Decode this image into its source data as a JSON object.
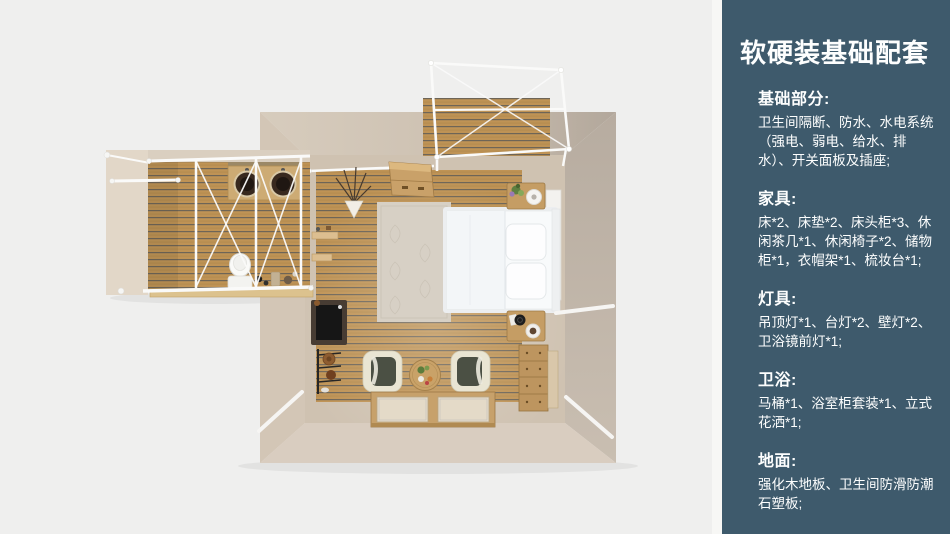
{
  "colors": {
    "canvas_bg": "#efefee",
    "panel_bg": "#3e5a6c",
    "panel_text": "#fdfefe",
    "wood": "#bf9355",
    "wood_gap": "#6e6557",
    "wall": "#cfc2b1",
    "wall_light": "#d8ccbe",
    "wall_dark": "#b3a89c",
    "frame_white": "#fafaf9",
    "bed_white": "#f8fafb"
  },
  "sidebar": {
    "title": "软硬装基础配套",
    "sections": [
      {
        "heading": "基础部分:",
        "body": "卫生间隔断、防水、水电系统（强电、弱电、给水、排水）、开关面板及插座;"
      },
      {
        "heading": "家具:",
        "body": "床*2、床垫*2、床头柜*3、休闲茶几*1、休闲椅子*2、储物柜*1，衣帽架*1、梳妆台*1;"
      },
      {
        "heading": "灯具:",
        "body": "吊顶灯*1、台灯*2、壁灯*2、卫浴镜前灯*1;"
      },
      {
        "heading": "卫浴:",
        "body": "马桶*1、浴室柜套装*1、立式花洒*1;"
      },
      {
        "heading": "地面:",
        "body": "强化木地板、卫生间防滑防潮石塑板;"
      }
    ]
  },
  "floorplan": {
    "view": "top-down-3d-render",
    "rooms": [
      "bedroom",
      "bathroom-wing",
      "balcony-deck"
    ],
    "elements": [
      "double-bed",
      "area-rug",
      "storage-cabinet",
      "nightstand",
      "nightstand",
      "lounge-chair",
      "lounge-chair",
      "coffee-table",
      "floor-windows",
      "dresser",
      "mirror-panel",
      "writing-desk",
      "coat-rack",
      "wall-shelf",
      "dried-plant",
      "double-sink-counter",
      "toilet",
      "partition-frame",
      "pergola-frame",
      "wood-slat-floor"
    ]
  }
}
